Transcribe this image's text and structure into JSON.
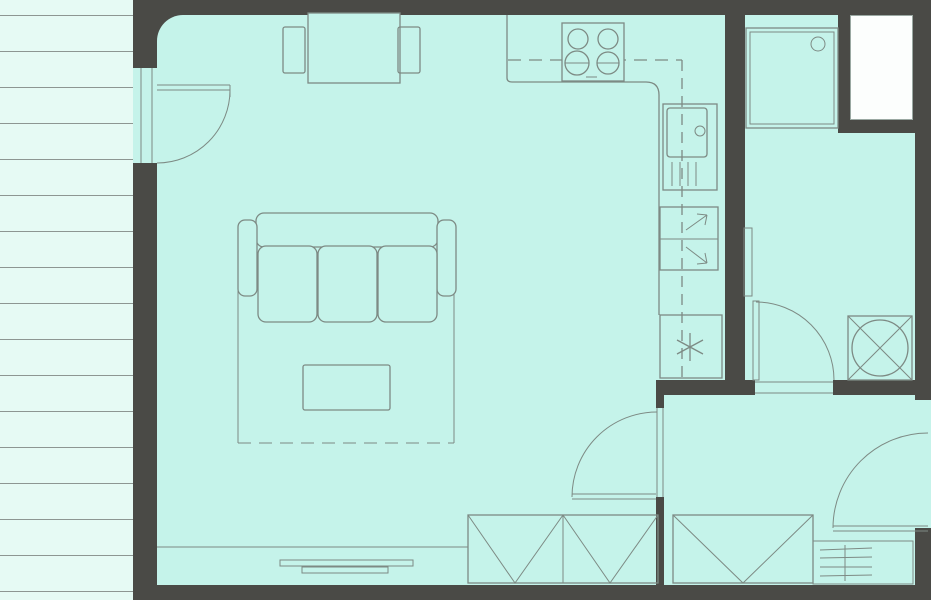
{
  "title": "Apartment floor plan",
  "diagram_type": "floor-plan",
  "colors": {
    "wall": "#4a4a46",
    "floor": "#c5f3ea",
    "terrace": "#e6faf4",
    "terrace_line": "#8d9692",
    "line": "#7d8a84",
    "shaft": "#fcfefd"
  },
  "rooms": [
    {
      "name": "terrace",
      "position": "left-strip",
      "features": [
        "plank-decking-stripes",
        "balcony-door-to-living-room"
      ]
    },
    {
      "name": "living-room-with-open-kitchen",
      "position": "center",
      "features": [
        "dining-table",
        "chair-left",
        "chair-right",
        "three-seat-sofa",
        "rug",
        "coffee-table",
        "radiator",
        "built-in-wardrobe-two-sections",
        "floor-line"
      ]
    },
    {
      "name": "kitchen-run",
      "position": "top-and-right-of-main-room",
      "features": [
        "countertop-L-shape",
        "hob-four-burners",
        "wall-cabinets-dashed-line",
        "sink-with-drainer",
        "dishwasher-with-arrows",
        "fridge-freezer-asterisk"
      ]
    },
    {
      "name": "bathroom",
      "position": "top-right",
      "features": [
        "shower-tray-with-drain",
        "towel-radiator",
        "washing-machine-circle-cross",
        "door-swing-bottom"
      ]
    },
    {
      "name": "hall",
      "position": "bottom-right",
      "features": [
        "entrance-door-swing",
        "built-in-wardrobe",
        "shoe-cabinet-hatched",
        "door-to-living-room"
      ]
    },
    {
      "name": "duct-shaft",
      "position": "top-right-corner",
      "features": [
        "white-rectangle"
      ]
    }
  ]
}
